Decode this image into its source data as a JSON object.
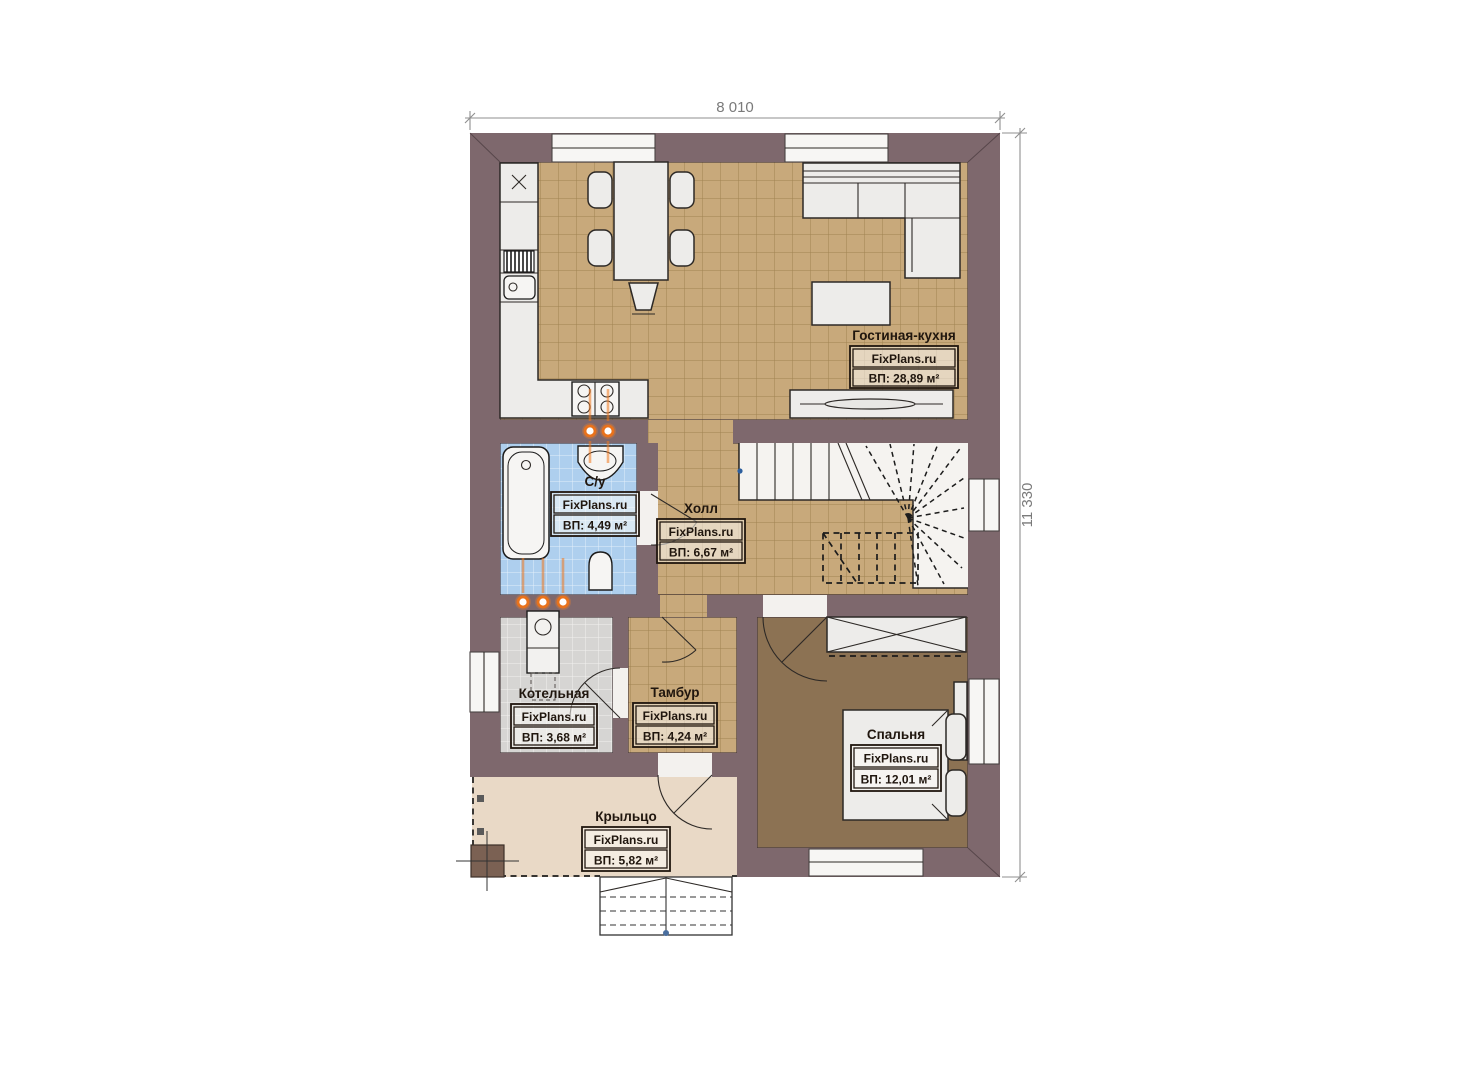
{
  "dimensions": {
    "width": "8 010",
    "height": "11 330"
  },
  "brand": "FixPlans.ru",
  "rooms": [
    {
      "name": "Гостиная-кухня",
      "area": "ВП: 28,89 м²"
    },
    {
      "name": "С/у",
      "area": "ВП: 4,49 м²"
    },
    {
      "name": "Холл",
      "area": "ВП: 6,67 м²"
    },
    {
      "name": "Котельная",
      "area": "ВП: 3,68 м²"
    },
    {
      "name": "Тамбур",
      "area": "ВП: 4,24 м²"
    },
    {
      "name": "Спальня",
      "area": "ВП: 12,01 м²"
    },
    {
      "name": "Крыльцо",
      "area": "ВП: 5,82 м²"
    }
  ]
}
